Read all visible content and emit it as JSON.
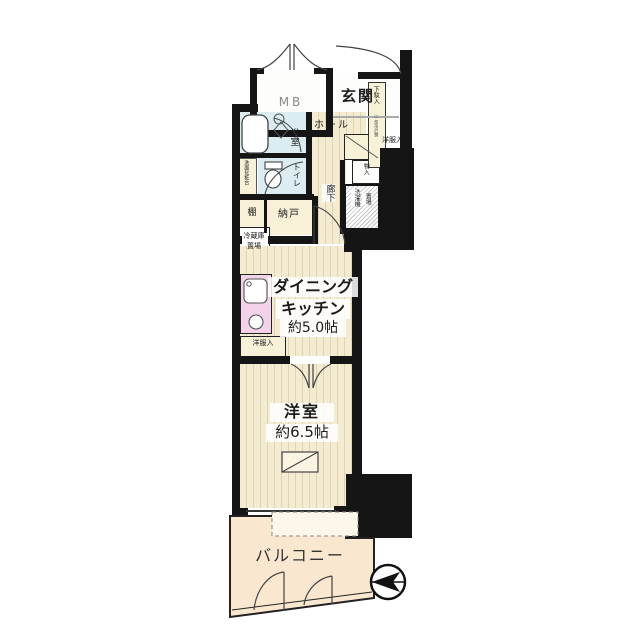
{
  "labels": {
    "mb": "MB",
    "entrance": "玄関",
    "entrance_hall": "ホール",
    "shoe_cabinet": "下駄入",
    "shoe_cabinet_note": "（一部吊戸棚）",
    "bathroom": "浴室",
    "toilet": "トイレ",
    "vanity": "洗面化粧台",
    "shelf": "棚",
    "storage_room": "納戸",
    "refrigerator_space": [
      "冷蔵庫",
      "置場"
    ],
    "washer_space": [
      "洗濯機",
      "置場"
    ],
    "corridor": "廊下",
    "closet_hall": "洋服入",
    "small_storage": "物入",
    "dining_kitchen": [
      "ダイニング",
      "キッチン",
      "約5.0帖"
    ],
    "closet_dk": "洋服入",
    "western_room": [
      "洋室",
      "約6.5帖"
    ],
    "balcony": "バルコニー"
  },
  "colors": {
    "wall": "#151515",
    "wood_floor": "#f4ebd3",
    "wood_stripe": "#e0d3ae",
    "wet_area": "#dcedf2",
    "cream_area": "#f7f1d8",
    "kitchen_counter": "#f2d3ea",
    "balcony_floor": "#f9e7cf"
  }
}
